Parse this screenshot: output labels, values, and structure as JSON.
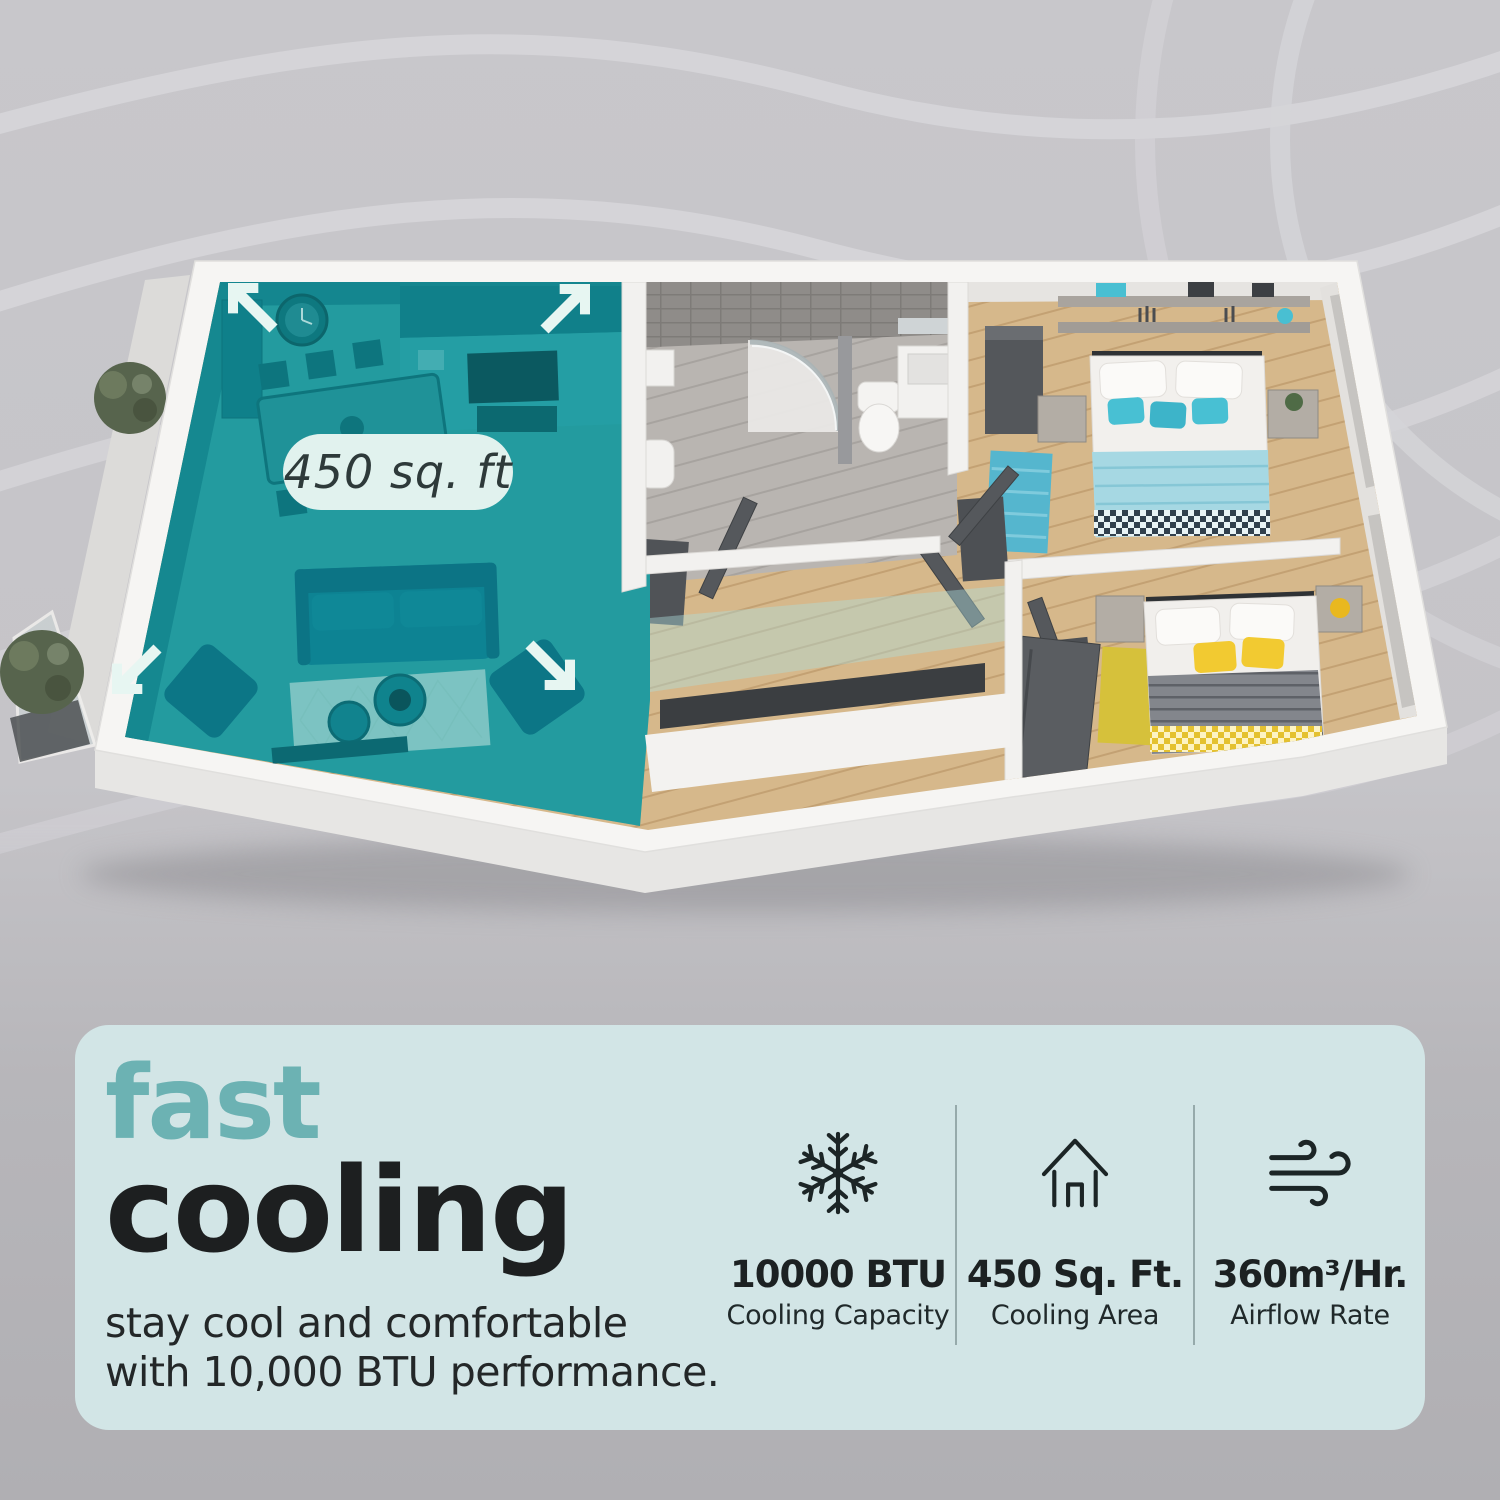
{
  "page": {
    "background": {
      "base_color": "#c6c5c9",
      "bottom_color": "#b0afb3",
      "wave_stripe_color": "#d5d4d8"
    }
  },
  "floor_plan": {
    "type": "3d-apartment-cutaway",
    "area_label": "450 sq. ft",
    "cooled_zone_color": "#1a98a0",
    "area_pill_color": "#e1f2ee",
    "expand_arrow_icon": "expand-arrows",
    "rooms": [
      "living-room-kitchen",
      "bathroom",
      "hallway",
      "bedroom-blue",
      "bedroom-yellow",
      "balcony"
    ]
  },
  "info_card": {
    "background_color": "#d2e5e6",
    "accent_color": "#6cb2b3",
    "text_color": "#1d1f20",
    "title_accent": "fast",
    "title_main": "cooling",
    "description_line1": "stay cool and comfortable",
    "description_line2": "with 10,000 BTU performance.",
    "stats": [
      {
        "icon": "snowflake-icon",
        "value": "10000 BTU",
        "label": "Cooling Capacity"
      },
      {
        "icon": "house-icon",
        "value": "450 Sq. Ft.",
        "label": "Cooling Area"
      },
      {
        "icon": "wind-icon",
        "value": "360m³/Hr.",
        "label": "Airflow Rate"
      }
    ]
  }
}
